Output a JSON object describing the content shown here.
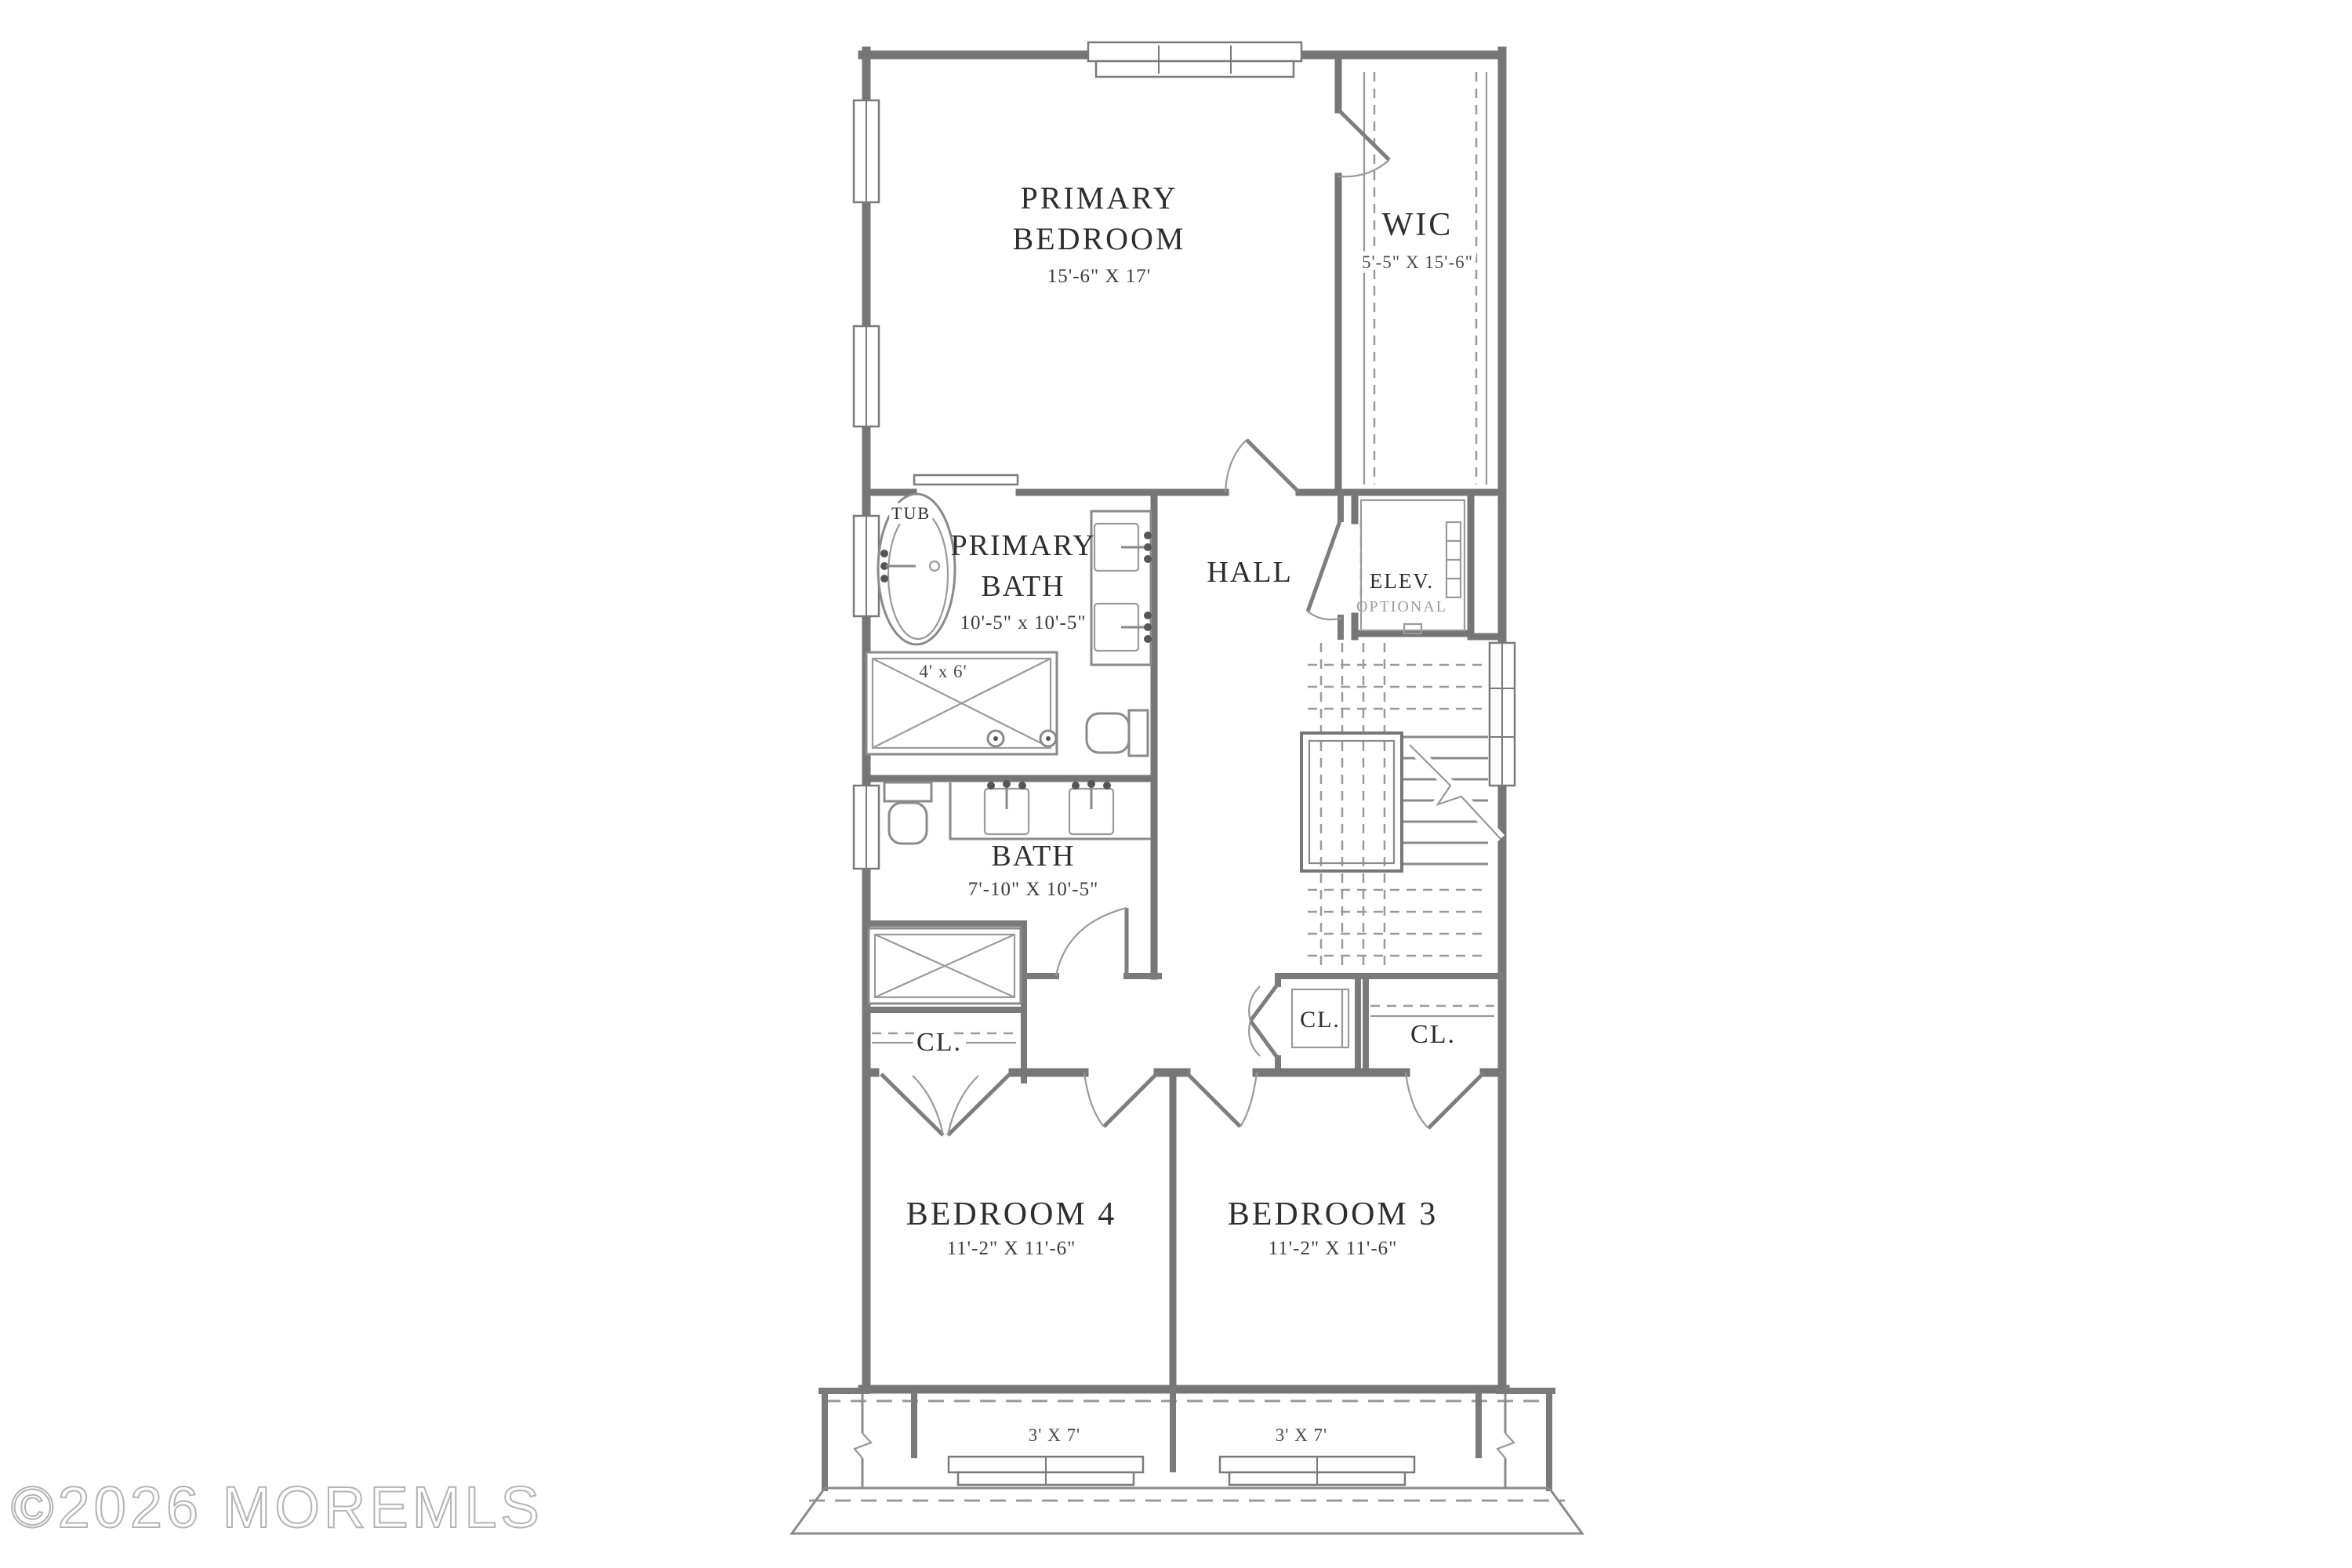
{
  "watermark": "©2026 MOREMLS",
  "colors": {
    "background": "#ffffff",
    "wall": "#767676",
    "fixture_line": "#8a8a8a",
    "dashed_line": "#9a9a9a",
    "label_text": "#2e2e2e",
    "muted_text": "#9d9d9d",
    "watermark": "#b3b3b3"
  },
  "rooms": {
    "primary_bedroom": {
      "line1": "PRIMARY",
      "line2": "BEDROOM",
      "dim": "15'-6\" X 17'"
    },
    "wic": {
      "name": "WIC",
      "dim": "5'-5\" X 15'-6\""
    },
    "primary_bath": {
      "line1": "PRIMARY",
      "line2": "BATH",
      "dim": "10'-5\" x 10'-5\""
    },
    "hall": {
      "name": "HALL"
    },
    "elevator": {
      "name": "ELEV.",
      "note": "OPTIONAL"
    },
    "bath": {
      "name": "BATH",
      "dim": "7'-10\" X 10'-5\""
    },
    "closet_bedroom4": {
      "name": "CL."
    },
    "closet_hall": {
      "name": "CL."
    },
    "closet_bedroom3": {
      "name": "CL."
    },
    "bedroom_4": {
      "name": "BEDROOM 4",
      "dim": "11'-2\" X 11'-6\""
    },
    "bedroom_3": {
      "name": "BEDROOM 3",
      "dim": "11'-2\" X 11'-6\""
    },
    "dormer_left": {
      "dim": "3' X 7'"
    },
    "dormer_right": {
      "dim": "3' X 7'"
    }
  },
  "fixtures": {
    "tub_label": "TUB",
    "shower_dim": "4' x 6'"
  }
}
